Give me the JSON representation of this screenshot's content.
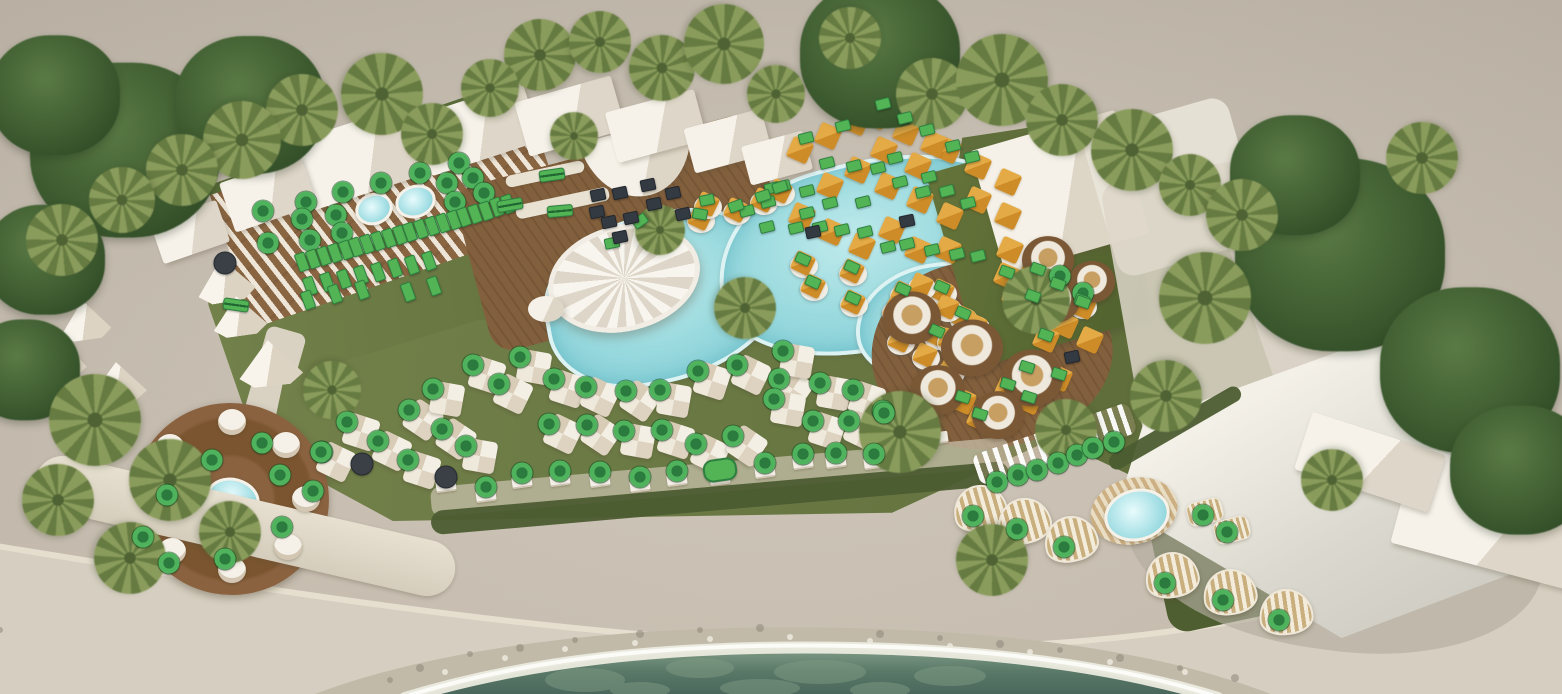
{
  "scene": {
    "width": 1562,
    "height": 694,
    "colors": {
      "ground": "#ccc3b6",
      "lawn": "#6e7c46",
      "deck": "#83603d",
      "pool": "#9adade",
      "sea": "#557466",
      "rocks": "#c2baa9",
      "promenade": "#d6cfc1",
      "orange_daybed": "#d6962e",
      "sail": "#e8e5dc",
      "building_green": "#5d6d35",
      "marker_available": "#4eb35c",
      "marker_available_center": "#2b7a3e",
      "marker_unavailable": "#3a4046"
    }
  },
  "markers": {
    "circle": [
      [
        263,
        211
      ],
      [
        306,
        202
      ],
      [
        302,
        219
      ],
      [
        310,
        240
      ],
      [
        268,
        243
      ],
      [
        343,
        192
      ],
      [
        336,
        215
      ],
      [
        342,
        233
      ],
      [
        381,
        183
      ],
      [
        420,
        173
      ],
      [
        447,
        183
      ],
      [
        459,
        163
      ],
      [
        473,
        178
      ],
      [
        484,
        193
      ],
      [
        455,
        202
      ],
      [
        520,
        357
      ],
      [
        554,
        379
      ],
      [
        586,
        387
      ],
      [
        626,
        391
      ],
      [
        660,
        390
      ],
      [
        698,
        371
      ],
      [
        737,
        365
      ],
      [
        779,
        379
      ],
      [
        820,
        383
      ],
      [
        853,
        390
      ],
      [
        549,
        424
      ],
      [
        587,
        425
      ],
      [
        624,
        431
      ],
      [
        662,
        430
      ],
      [
        696,
        444
      ],
      [
        733,
        436
      ],
      [
        774,
        399
      ],
      [
        813,
        421
      ],
      [
        849,
        421
      ],
      [
        883,
        411
      ],
      [
        783,
        351
      ],
      [
        347,
        422
      ],
      [
        378,
        441
      ],
      [
        409,
        410
      ],
      [
        433,
        389
      ],
      [
        473,
        365
      ],
      [
        499,
        384
      ],
      [
        442,
        429
      ],
      [
        466,
        446
      ],
      [
        408,
        460
      ],
      [
        322,
        452
      ],
      [
        212,
        460
      ],
      [
        262,
        443
      ],
      [
        280,
        475
      ],
      [
        167,
        495
      ],
      [
        143,
        537
      ],
      [
        169,
        563
      ],
      [
        225,
        559
      ],
      [
        282,
        527
      ],
      [
        313,
        491
      ],
      [
        321,
        452
      ],
      [
        486,
        487
      ],
      [
        522,
        473
      ],
      [
        560,
        471
      ],
      [
        600,
        472
      ],
      [
        640,
        477
      ],
      [
        677,
        471
      ],
      [
        765,
        463
      ],
      [
        803,
        454
      ],
      [
        836,
        453
      ],
      [
        874,
        454
      ],
      [
        997,
        482
      ],
      [
        1018,
        475
      ],
      [
        1037,
        470
      ],
      [
        1058,
        463
      ],
      [
        1077,
        455
      ],
      [
        1093,
        448
      ],
      [
        1114,
        442
      ],
      [
        973,
        516
      ],
      [
        1017,
        529
      ],
      [
        1064,
        547
      ],
      [
        1165,
        583
      ],
      [
        1223,
        600
      ],
      [
        1279,
        620
      ],
      [
        1203,
        515
      ],
      [
        1227,
        532
      ],
      [
        1060,
        276
      ],
      [
        1083,
        293
      ],
      [
        884,
        413
      ]
    ],
    "rect_vertical": [
      [
        302,
        262
      ],
      [
        313,
        259
      ],
      [
        324,
        256
      ],
      [
        335,
        253
      ],
      [
        346,
        250
      ],
      [
        356,
        247
      ],
      [
        367,
        244
      ],
      [
        378,
        241
      ],
      [
        389,
        238
      ],
      [
        400,
        235
      ],
      [
        410,
        232
      ],
      [
        421,
        229
      ],
      [
        432,
        226
      ],
      [
        443,
        223
      ],
      [
        454,
        220
      ],
      [
        464,
        217
      ],
      [
        475,
        214
      ],
      [
        486,
        211
      ],
      [
        497,
        207
      ],
      [
        508,
        204
      ],
      [
        310,
        286
      ],
      [
        327,
        282
      ],
      [
        344,
        279
      ],
      [
        361,
        275
      ],
      [
        378,
        272
      ],
      [
        395,
        268
      ],
      [
        412,
        265
      ],
      [
        429,
        261
      ],
      [
        308,
        300
      ],
      [
        335,
        294
      ],
      [
        362,
        290
      ],
      [
        408,
        292
      ],
      [
        434,
        286
      ]
    ],
    "rect": [
      [
        883,
        104
      ],
      [
        905,
        118
      ],
      [
        927,
        130
      ],
      [
        953,
        146
      ],
      [
        972,
        157
      ],
      [
        843,
        126
      ],
      [
        806,
        138
      ],
      [
        827,
        163
      ],
      [
        878,
        168
      ],
      [
        900,
        182
      ],
      [
        923,
        192
      ],
      [
        947,
        191
      ],
      [
        968,
        203
      ],
      [
        807,
        191
      ],
      [
        830,
        203
      ],
      [
        863,
        202
      ],
      [
        772,
        188
      ],
      [
        783,
        186
      ],
      [
        768,
        202
      ],
      [
        747,
        211
      ],
      [
        767,
        227
      ],
      [
        796,
        228
      ],
      [
        820,
        227
      ],
      [
        842,
        230
      ],
      [
        865,
        232
      ],
      [
        888,
        247
      ],
      [
        907,
        244
      ],
      [
        932,
        250
      ],
      [
        957,
        254
      ],
      [
        978,
        256
      ],
      [
        807,
        213
      ],
      [
        895,
        158
      ],
      [
        854,
        166
      ],
      [
        929,
        177
      ],
      [
        736,
        206,
        -20
      ],
      [
        700,
        214,
        10
      ],
      [
        707,
        200,
        -12
      ],
      [
        763,
        196,
        -18
      ],
      [
        780,
        187,
        -18
      ],
      [
        803,
        259,
        24
      ],
      [
        813,
        282,
        24
      ],
      [
        852,
        267,
        24
      ],
      [
        853,
        298,
        24
      ],
      [
        640,
        221,
        -35
      ],
      [
        612,
        243,
        -12
      ],
      [
        903,
        289,
        24
      ],
      [
        942,
        287,
        24
      ],
      [
        963,
        313,
        24
      ],
      [
        937,
        331,
        24
      ],
      [
        1046,
        335,
        20
      ],
      [
        1058,
        284,
        20
      ],
      [
        1082,
        300,
        20
      ],
      [
        1027,
        367,
        18
      ],
      [
        1008,
        384,
        18
      ],
      [
        1029,
        397,
        18
      ],
      [
        1059,
        374,
        18
      ],
      [
        963,
        397,
        18
      ],
      [
        980,
        414,
        18
      ],
      [
        1007,
        272,
        20
      ],
      [
        1038,
        269,
        20
      ],
      [
        1033,
        296,
        20
      ],
      [
        1083,
        302,
        20
      ]
    ],
    "rect_wide": [
      [
        552,
        175,
        -8
      ],
      [
        560,
        211,
        -5
      ],
      [
        510,
        205,
        -10
      ],
      [
        236,
        305,
        8
      ]
    ],
    "stadium": [
      [
        720,
        470,
        -8
      ]
    ],
    "dark_circle": [
      [
        225,
        263
      ],
      [
        362,
        464
      ],
      [
        446,
        477
      ]
    ],
    "dark_rect": [
      [
        598,
        195
      ],
      [
        620,
        193
      ],
      [
        648,
        185
      ],
      [
        673,
        193
      ],
      [
        597,
        212
      ],
      [
        609,
        222
      ],
      [
        620,
        237
      ],
      [
        631,
        218
      ],
      [
        654,
        204
      ],
      [
        683,
        214
      ],
      [
        907,
        221
      ],
      [
        813,
        232
      ],
      [
        1072,
        357
      ]
    ]
  },
  "decor": {
    "trees": [
      [
        125,
        150,
        190
      ],
      [
        250,
        105,
        150
      ],
      [
        55,
        95,
        130
      ],
      [
        45,
        260,
        120
      ],
      [
        880,
        55,
        160
      ],
      [
        1340,
        255,
        210
      ],
      [
        1470,
        370,
        180
      ],
      [
        1295,
        175,
        130
      ],
      [
        1520,
        470,
        140
      ],
      [
        25,
        370,
        110
      ]
    ],
    "palms": [
      [
        540,
        55,
        72
      ],
      [
        600,
        42,
        62
      ],
      [
        662,
        68,
        66
      ],
      [
        724,
        44,
        80
      ],
      [
        776,
        94,
        58
      ],
      [
        850,
        38,
        62
      ],
      [
        932,
        94,
        72
      ],
      [
        1002,
        80,
        92
      ],
      [
        1062,
        120,
        72
      ],
      [
        1132,
        150,
        82
      ],
      [
        1190,
        185,
        62
      ],
      [
        1242,
        215,
        72
      ],
      [
        382,
        94,
        82
      ],
      [
        302,
        110,
        72
      ],
      [
        242,
        140,
        78
      ],
      [
        182,
        170,
        72
      ],
      [
        122,
        200,
        66
      ],
      [
        62,
        240,
        72
      ],
      [
        432,
        134,
        62
      ],
      [
        490,
        88,
        58
      ],
      [
        574,
        136,
        48
      ],
      [
        660,
        230,
        50
      ],
      [
        745,
        308,
        62
      ],
      [
        1036,
        300,
        68
      ],
      [
        1205,
        298,
        92
      ],
      [
        1166,
        396,
        72
      ],
      [
        900,
        432,
        82
      ],
      [
        1066,
        430,
        62
      ],
      [
        95,
        420,
        92
      ],
      [
        170,
        480,
        82
      ],
      [
        58,
        500,
        72
      ],
      [
        230,
        532,
        62
      ],
      [
        130,
        558,
        72
      ],
      [
        332,
        390,
        58
      ],
      [
        992,
        560,
        72
      ],
      [
        1332,
        480,
        62
      ],
      [
        1422,
        158,
        72
      ]
    ],
    "buildings": [
      [
        365,
        156,
        130,
        72,
        -18
      ],
      [
        477,
        129,
        115,
        62,
        -18
      ],
      [
        570,
        116,
        100,
        56,
        -16
      ],
      [
        656,
        126,
        92,
        52,
        -15
      ],
      [
        728,
        141,
        80,
        46,
        -15
      ],
      [
        777,
        158,
        64,
        40,
        -15
      ],
      [
        268,
        194,
        86,
        52,
        -19
      ],
      [
        190,
        232,
        70,
        44,
        -19
      ],
      [
        1500,
        520,
        200,
        100,
        15
      ],
      [
        1370,
        462,
        140,
        60,
        18
      ]
    ],
    "tents": [
      [
        225,
        280,
        58,
        44,
        -10
      ],
      [
        239,
        316,
        54,
        40,
        -8
      ],
      [
        270,
        363,
        64,
        46,
        -6
      ],
      [
        54,
        355,
        64,
        50,
        -4
      ],
      [
        118,
        382,
        56,
        40,
        -6
      ],
      [
        85,
        320,
        50,
        40,
        -8
      ]
    ],
    "umbrellas": [
      [
        534,
        367
      ],
      [
        568,
        389
      ],
      [
        600,
        397
      ],
      [
        640,
        401
      ],
      [
        674,
        400
      ],
      [
        712,
        381
      ],
      [
        751,
        375
      ],
      [
        793,
        389
      ],
      [
        834,
        393
      ],
      [
        867,
        400
      ],
      [
        563,
        434
      ],
      [
        601,
        435
      ],
      [
        638,
        441
      ],
      [
        676,
        440
      ],
      [
        710,
        454
      ],
      [
        747,
        446
      ],
      [
        788,
        409
      ],
      [
        827,
        431
      ],
      [
        863,
        431
      ],
      [
        897,
        421
      ],
      [
        797,
        361
      ],
      [
        361,
        432
      ],
      [
        392,
        451
      ],
      [
        423,
        420
      ],
      [
        447,
        399
      ],
      [
        487,
        375
      ],
      [
        513,
        394
      ],
      [
        456,
        439
      ],
      [
        480,
        456
      ],
      [
        422,
        470
      ],
      [
        336,
        462
      ]
    ],
    "pool_daybeds": [
      [
        736,
        210
      ],
      [
        700,
        218
      ],
      [
        707,
        204
      ],
      [
        763,
        200
      ],
      [
        780,
        191
      ],
      [
        803,
        263
      ],
      [
        813,
        286
      ],
      [
        852,
        271
      ],
      [
        853,
        302
      ],
      [
        903,
        293
      ],
      [
        942,
        291
      ],
      [
        963,
        317
      ],
      [
        937,
        335
      ],
      [
        1058,
        288
      ],
      [
        1082,
        304
      ],
      [
        895,
        310
      ],
      [
        920,
        325
      ],
      [
        947,
        307
      ],
      [
        921,
        285
      ],
      [
        900,
        340
      ],
      [
        925,
        355
      ],
      [
        950,
        340
      ],
      [
        975,
        325
      ],
      [
        975,
        355
      ],
      [
        950,
        370
      ]
    ],
    "deck_daybeds": [
      [
        800,
        150
      ],
      [
        828,
        136
      ],
      [
        856,
        122
      ],
      [
        884,
        150
      ],
      [
        858,
        170
      ],
      [
        830,
        186
      ],
      [
        888,
        186
      ],
      [
        918,
        166
      ],
      [
        948,
        150
      ],
      [
        920,
        200
      ],
      [
        950,
        216
      ],
      [
        978,
        200
      ],
      [
        802,
        216
      ],
      [
        832,
        232
      ],
      [
        862,
        246
      ],
      [
        892,
        230
      ],
      [
        978,
        166
      ],
      [
        948,
        250
      ],
      [
        918,
        250
      ],
      [
        1008,
        216
      ],
      [
        1008,
        182
      ],
      [
        876,
        116
      ],
      [
        906,
        132
      ],
      [
        934,
        144
      ],
      [
        1010,
        250
      ],
      [
        1035,
        265
      ],
      [
        1060,
        280
      ],
      [
        1040,
        310
      ],
      [
        1065,
        325
      ],
      [
        1090,
        340
      ],
      [
        1015,
        295
      ],
      [
        1046,
        339
      ],
      [
        1027,
        371
      ],
      [
        1008,
        388
      ],
      [
        1029,
        401
      ],
      [
        1059,
        378
      ],
      [
        963,
        401
      ],
      [
        980,
        418
      ],
      [
        1007,
        276
      ],
      [
        1038,
        273
      ],
      [
        1033,
        300
      ],
      [
        1083,
        306
      ]
    ],
    "sun_loungers": [
      [
        486,
        496
      ],
      [
        522,
        482
      ],
      [
        560,
        480
      ],
      [
        600,
        481
      ],
      [
        640,
        486
      ],
      [
        677,
        480
      ],
      [
        720,
        479
      ],
      [
        765,
        472
      ],
      [
        803,
        463
      ],
      [
        836,
        462
      ],
      [
        874,
        463
      ],
      [
        446,
        486
      ],
      [
        908,
        447
      ],
      [
        938,
        438
      ]
    ],
    "booths": [
      [
        912,
        318,
        58
      ],
      [
        972,
        348,
        62
      ],
      [
        1032,
        378,
        62
      ],
      [
        938,
        390,
        54
      ],
      [
        998,
        415,
        52
      ],
      [
        1055,
        300,
        50
      ],
      [
        1048,
        260,
        52
      ],
      [
        1092,
        282,
        46
      ]
    ],
    "cabanas": [
      [
        980,
        508,
        -14
      ],
      [
        1024,
        521,
        -14
      ],
      [
        1071,
        539,
        -12
      ],
      [
        1172,
        575,
        -10
      ],
      [
        1230,
        592,
        -8
      ],
      [
        1286,
        612,
        -6
      ]
    ],
    "striped_loungers": [
      [
        1205,
        512
      ],
      [
        1232,
        530
      ]
    ],
    "crescent_daybeds": [
      [
        232,
        422
      ],
      [
        286,
        445
      ],
      [
        306,
        499
      ],
      [
        288,
        547
      ],
      [
        232,
        570
      ],
      [
        172,
        551
      ],
      [
        152,
        499
      ],
      [
        170,
        447
      ]
    ]
  }
}
